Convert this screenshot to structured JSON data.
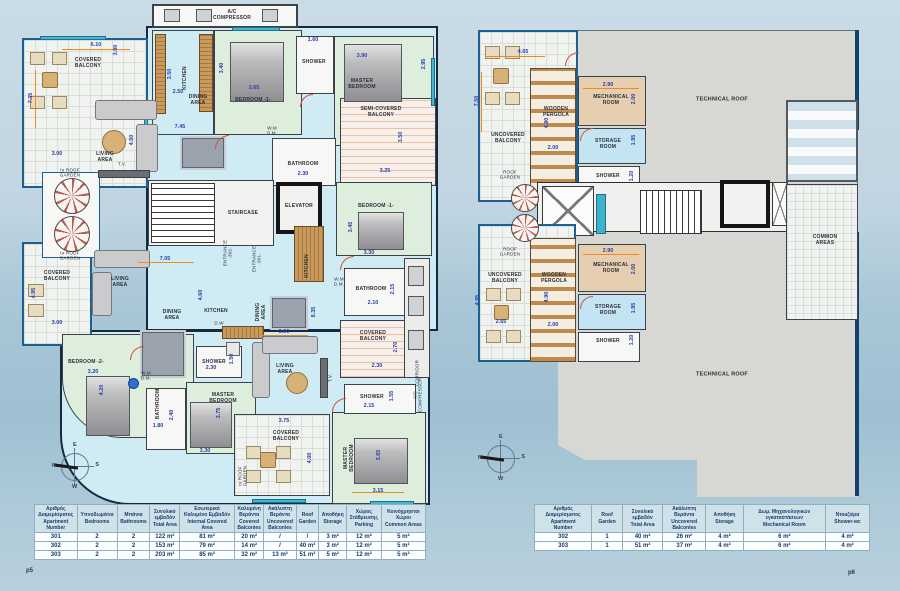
{
  "footer": {
    "page_left": "p5",
    "page_right": "p6"
  },
  "compass": {
    "n": "N",
    "e": "E",
    "s": "S",
    "w": "W"
  },
  "lp": {
    "labels": {
      "ac_top": "A/C\nCOMPRESSOR",
      "covered_balcony_tl": "COVERED\nBALCONY",
      "kitchen_top": "KITCHEN",
      "bedroom1_top": "BEDROOM -1-",
      "shower_top": "SHOWER",
      "master_top": "MASTER\nBEDROOM",
      "dining_top": "DINING\nAREA",
      "living_top": "LIVING\nAREA",
      "tv_top": "T.V.",
      "to_roof_1": "to ROOF\nGARDEN",
      "semi_balcony": "SEMI-COVERED\nBALCONY",
      "wm_1": "W.M\nD.M.",
      "bathroom_1": "BATHROOM",
      "staircase": "STAIRCASE",
      "elevator": "ELEVATOR",
      "entrance_302": "ENTRANCE\n-302-",
      "entrance_301": "ENTRANCE\n-301-",
      "kitchen_right": "KITCHEN",
      "wm_2": "W.M\nD.M.",
      "bedroom1_right": "BEDROOM -1-",
      "to_roof_2": "to ROOF\nGARDEN",
      "covered_balcony_left": "COVERED\nBALCONY",
      "living_left": "LIVING\nAREA",
      "dining_mid": "DINING\nAREA",
      "kitchen_mid": "KITCHEN",
      "dw_mid": "D.W",
      "dining_right": "DINING\nAREA",
      "bathroom_right": "BATHROOM",
      "covered_balcony_right": "COVERED\nBALCONY",
      "corridor": "CORRIDOR",
      "bedroom_2": "BEDROOM -2-",
      "wm_3": "W.M\nD.M.",
      "bathroom_bottom": "BATHROOM",
      "master_left": "MASTER\nBEDROOM",
      "shower_left": "SHOWER",
      "living_bottom": "LIVING\nAREA",
      "tv_bottom": "T.V.",
      "covered_balcony_bottom": "COVERED\nBALCONY",
      "to_roof_3": "to ROOF\nGARDEN",
      "master_br": "MASTER\nBEDROOM",
      "shower_br": "SHOWER",
      "ac_right": "A/C\nCOMPRESSOR"
    },
    "dims": [
      "6.10",
      "3.00",
      "7.35",
      "3.00",
      "3.50",
      "2.50",
      "3.65",
      "3.40",
      "1.60",
      "3.90",
      "2.95",
      "3.50",
      "3.25",
      "2.30",
      "7.45",
      "4.00",
      "7.05",
      "4.60",
      "3.45",
      "3.30",
      "2.10",
      "2.15",
      "2.30",
      "2.70",
      "4.95",
      "3.00",
      "3.20",
      "4.20",
      "1.80",
      "2.40",
      "3.75",
      "3.30",
      "2.30",
      "1.50",
      "3.90",
      "8.35",
      "3.75",
      "4.00",
      "3.65",
      "3.15",
      "2.15",
      "1.55"
    ]
  },
  "rp": {
    "labels": {
      "uncovered_1": "UNCOVERED\nBALCONY",
      "pergola_1": "WOODEN\nPERGOLA",
      "mech_1": "MECHANICAL\nROOM",
      "storage_1": "STORAGE\nROOM",
      "shower_1": "SHOWER",
      "tech_top": "TECHNICAL ROOF",
      "common": "COMMON\nAREAS",
      "roof_garden_a": "ROOF\nGARDEN",
      "roof_garden_b": "ROOF\nGARDEN",
      "uncovered_2": "UNCOVERED\nBALCONY",
      "pergola_2": "WOODEN\nPERGOLA",
      "mech_2": "MECHANICAL\nROOM",
      "storage_2": "STORAGE\nROOM",
      "shower_2": "SHOWER",
      "tech_bottom": "TECHNICAL ROOF"
    },
    "dims": [
      "4.65",
      "7.50",
      "2.90",
      "2.00",
      "4.90",
      "2.00",
      "1.95",
      "1.20",
      "4.95",
      "2.65",
      "4.90",
      "2.00",
      "2.90",
      "2.00",
      "1.95",
      "1.20"
    ]
  },
  "tables": {
    "left": {
      "columns": [
        "Αριθμός\nΔιαμερίσματος\nApartment\nNumber",
        "Υπνοδωμάτια\nBedrooms",
        "Μπάνια\nBathrooms",
        "Συνολικό\nεμβαδόν\nTotal Area",
        "Εσωτερικό\nΚαλυμένο Εμβαδόν\nInternal Covered\nArea",
        "Καλυμένη\nΒεράντα\nCovered\nBalconies",
        "Ακάλυπτη\nΒεράντα\nUncovered\nBalconies",
        "Roof\nGarden",
        "Αποθήκη\nStorage",
        "Χώρος\nΣτάθμευσης\nParking",
        "Κοινόχρηστοι\nΧώροι\nCommon Areas"
      ],
      "rows": [
        [
          "301",
          "2",
          "2",
          "122 m²",
          "81 m²",
          "20 m²",
          "/",
          "/",
          "3 m²",
          "12 m²",
          "5 m²"
        ],
        [
          "302",
          "2",
          "2",
          "153 m²",
          "79 m²",
          "14 m²",
          "/",
          "40 m²",
          "3 m²",
          "12 m²",
          "5 m²"
        ],
        [
          "303",
          "2",
          "2",
          "203 m²",
          "85 m²",
          "32 m²",
          "13 m²",
          "51 m²",
          "5 m²",
          "12 m²",
          "5 m²"
        ]
      ]
    },
    "right": {
      "columns": [
        "Αριθμός\nΔιαμερίσματος\nApartment\nNumber",
        "Roof\nGarden",
        "Συνολικό\nεμβαδόν\nTotal Area",
        "Ακάλυπτη\nΒεράντα\nUncovered\nBalconies",
        "Αποθήκη\nStorage",
        "Δωμ. Μηχανολογικών\nεγκαταστάσεων\nMechanical Room",
        "Ντουζιέρα\nShower-wc"
      ],
      "rows": [
        [
          "302",
          "1",
          "40 m²",
          "26 m²",
          "4 m²",
          "6 m²",
          "4 m²"
        ],
        [
          "303",
          "1",
          "51 m²",
          "37 m²",
          "4 m²",
          "6 m²",
          "4 m²"
        ]
      ]
    }
  }
}
